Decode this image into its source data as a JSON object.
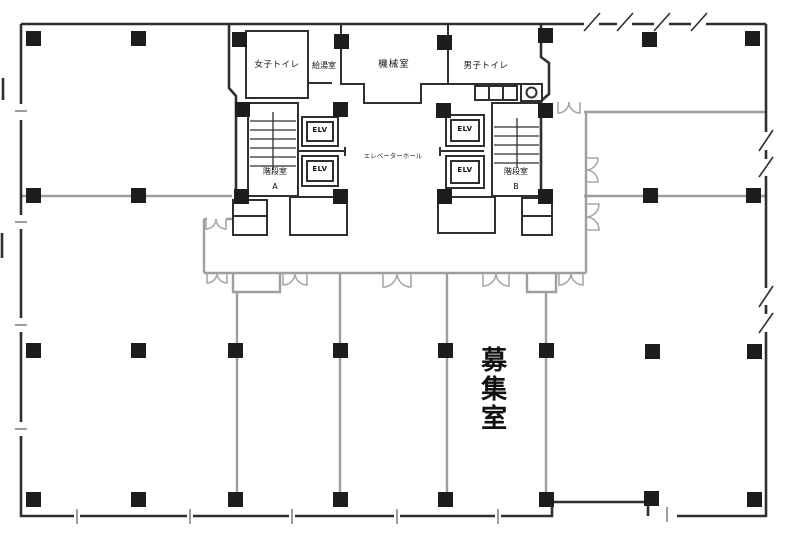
{
  "rooms": {
    "womens_toilet": "女子トイレ",
    "kitchenette": "給湯室",
    "machine_room": "機械室",
    "mens_toilet": "男子トイレ",
    "elevator_hall": "エレベーターホール",
    "stairwell": "階段室",
    "stairwell_a": "A",
    "stairwell_b": "B",
    "elevator": "ELV",
    "vacancy": "募集室"
  },
  "colors": {
    "wall_dark": "#2f2f2f",
    "wall_light": "#9e9e9e",
    "door_arc": "#a8a8a8",
    "column_fill": "#1d1d1d",
    "label_text": "#111111",
    "background": "#ffffff"
  }
}
